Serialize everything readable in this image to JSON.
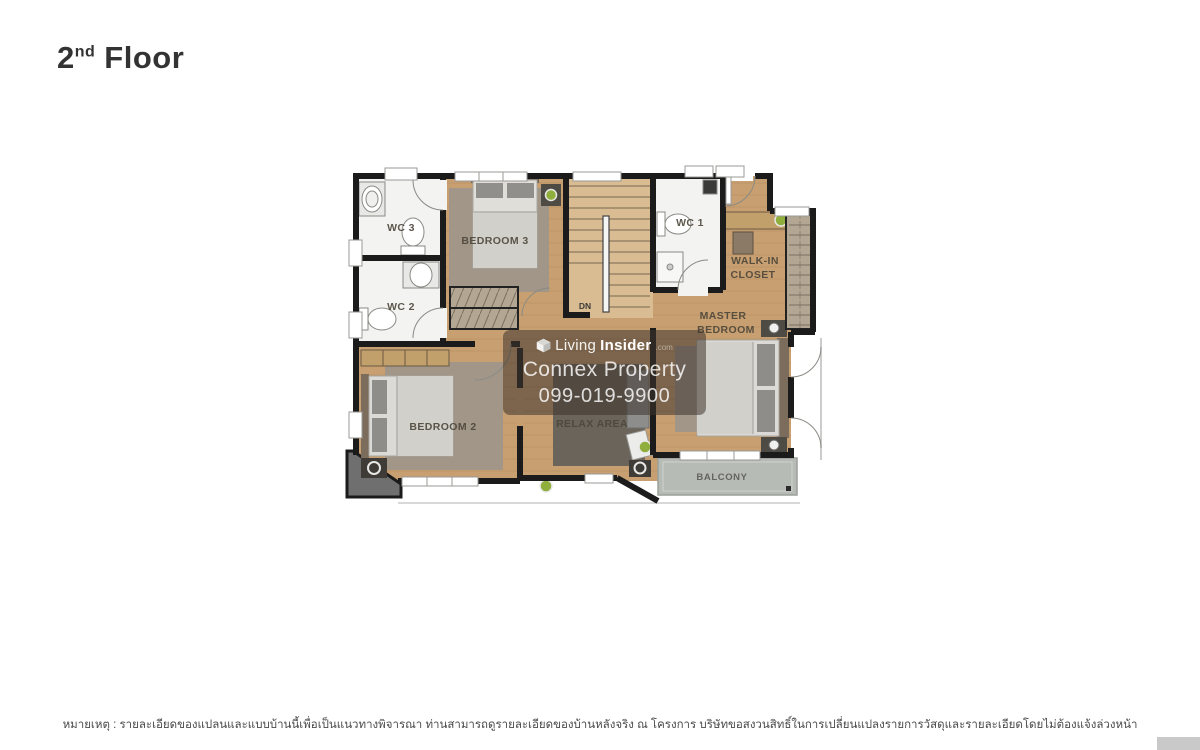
{
  "header": {
    "floor_number": "2",
    "floor_ordinal": "nd",
    "floor_word": "Floor"
  },
  "floorplan": {
    "rooms": {
      "wc3": "WC 3",
      "wc2": "WC 2",
      "bedroom3": "BEDROOM 3",
      "wc1": "WC 1",
      "walkin_line1": "WALK-IN",
      "walkin_line2": "CLOSET",
      "master_line1": "MASTER",
      "master_line2": "BEDROOM",
      "bedroom2": "BEDROOM 2",
      "relax_area": "RELAX AREA",
      "balcony": "BALCONY",
      "stairs_direction": "DN"
    }
  },
  "watermark": {
    "brand_part1": "Living",
    "brand_part2": "Insider",
    "brand_suffix": ".com",
    "company": "Connex Property",
    "phone": "099-019-9900"
  },
  "footer": {
    "note": "หมายเหตุ : รายละเอียดของแปลนและแบบบ้านนี้เพื่อเป็นแนวทางพิจารณา ท่านสามารถดูรายละเอียดของบ้านหลังจริง ณ โครงการ บริษัทขอสงวนสิทธิ์ในการเปลี่ยนแปลงรายการวัสดุและรายละเอียดโดยไม่ต้องแจ้งล่วงหน้า"
  },
  "colors": {
    "wall": "#1b1b1b",
    "wood_floor": "#c79f71",
    "wood_stairs": "#d9bc92",
    "tile": "#f3f3f1",
    "rug": "#a0968a",
    "rug_dark": "#6b645a",
    "balcony_floor": "#b7bbb6",
    "plant_green": "#8fae3c",
    "watermark_bg": "rgba(62,53,45,0.55)",
    "title_text": "#333333",
    "room_label_text": "#4c463a",
    "footer_text": "#4a4a4a"
  }
}
